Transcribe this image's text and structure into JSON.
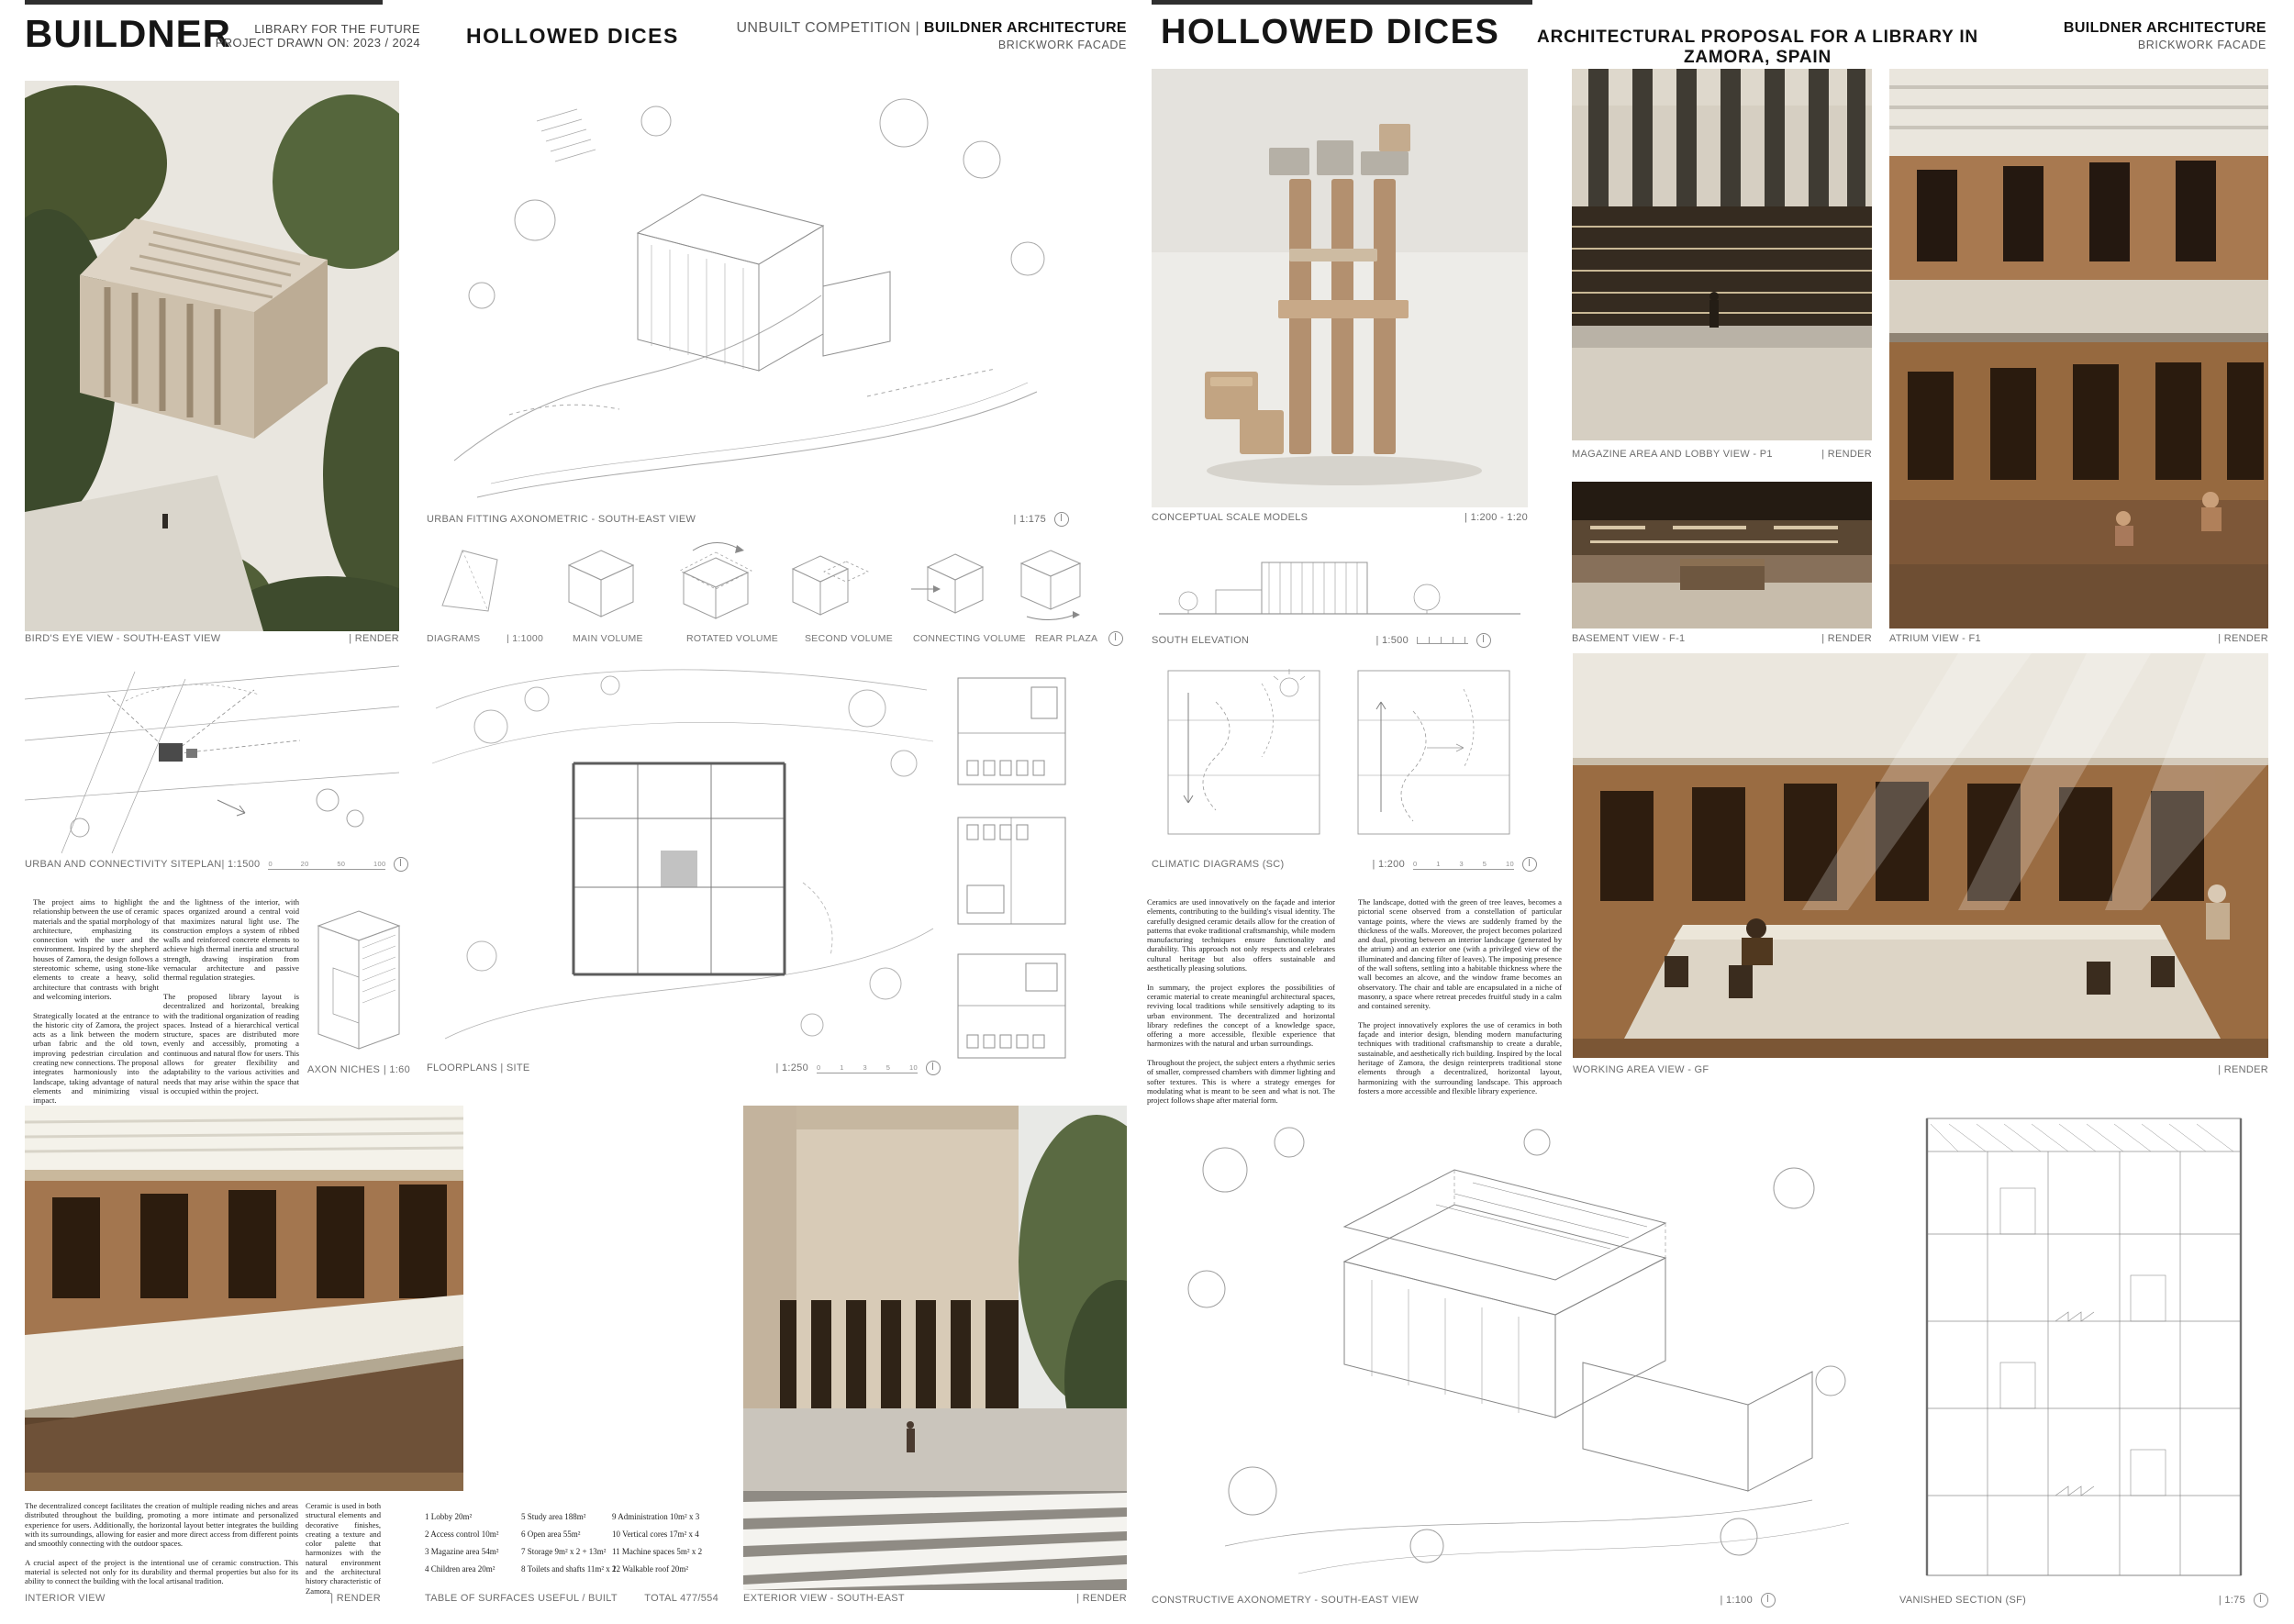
{
  "board_left": {
    "header": {
      "logo": "BUILDNER",
      "competition_line1": "LIBRARY FOR THE FUTURE",
      "competition_line2": "PROJECT DRAWN ON: 2023 / 2024",
      "title": "HOLLOWED DICES",
      "meta_regular": "UNBUILT COMPETITION | ",
      "meta_bold": "BUILDNER ARCHITECTURE",
      "meta_sub": "BRICKWORK FACADE"
    }
  },
  "board_right": {
    "header": {
      "title": "HOLLOWED DICES",
      "subtitle": "ARCHITECTURAL PROPOSAL FOR A LIBRARY IN ZAMORA, SPAIN",
      "meta_bold": "BUILDNER ARCHITECTURE",
      "meta_sub": "BRICKWORK FACADE"
    }
  },
  "captions": {
    "birds_eye": {
      "label": "BIRD'S EYE VIEW - SOUTH-EAST VIEW",
      "tag": "| RENDER"
    },
    "urban_axo": {
      "label": "URBAN FITTING AXONOMETRIC - SOUTH-EAST VIEW",
      "tag": "| 1:175"
    },
    "diagrams": {
      "label": "DIAGRAMS",
      "tag": "| 1:1000"
    },
    "siteplan": {
      "label": "URBAN AND CONNECTIVITY SITEPLAN",
      "tag": "| 1:1500"
    },
    "axon_niches": {
      "label": "AXON NICHES",
      "tag": "| 1:60"
    },
    "floorplans": {
      "label": "FLOORPLANS | SITE",
      "tag": "| 1:250"
    },
    "conceptual": {
      "label": "CONCEPTUAL SCALE MODELS",
      "tag": "| 1:200 - 1:20"
    },
    "south_elevation": {
      "label": "SOUTH ELEVATION",
      "tag": "| 1:500"
    },
    "climatic": {
      "label": "CLIMATIC DIAGRAMS (SC)",
      "tag": "| 1:200"
    },
    "magazine": {
      "label": "MAGAZINE AREA AND LOBBY VIEW - P1",
      "tag": "| RENDER"
    },
    "basement": {
      "label": "BASEMENT VIEW - F-1",
      "tag": "| RENDER"
    },
    "atrium": {
      "label": "ATRIUM VIEW - F1",
      "tag": "| RENDER"
    },
    "working": {
      "label": "WORKING AREA VIEW - GF",
      "tag": "| RENDER"
    },
    "interior": {
      "label": "INTERIOR VIEW",
      "tag": "| RENDER"
    },
    "table_surfaces": {
      "label": "TABLE OF SURFACES USEFUL / BUILT",
      "tag": "TOTAL 477/554"
    },
    "exterior": {
      "label": "EXTERIOR VIEW - SOUTH-EAST",
      "tag": "| RENDER"
    },
    "constructive": {
      "label": "CONSTRUCTIVE AXONOMETRY - SOUTH-EAST VIEW",
      "tag": "| 1:100"
    },
    "vanished": {
      "label": "VANISHED SECTION (SF)",
      "tag": "| 1:75"
    }
  },
  "diagram_labels": [
    "MAIN VOLUME",
    "ROTATED VOLUME",
    "SECOND VOLUME",
    "CONNECTING VOLUME",
    "REAR PLAZA"
  ],
  "scale_bars": {
    "siteplan": [
      "0",
      "20",
      "50",
      "100"
    ],
    "floorplans": [
      "0",
      "1",
      "3",
      "5",
      "10"
    ],
    "climatic": [
      "0",
      "1",
      "3",
      "5",
      "10"
    ]
  },
  "texts": {
    "left_col1": "The project aims to highlight the relationship between the use of ceramic materials and the spatial morphology of architecture, emphasizing its connection with the user and the environment. Inspired by the shepherd houses of Zamora, the design follows a stereotomic scheme, using stone-like elements to create a heavy, solid architecture that contrasts with bright and welcoming interiors.\n\nStrategically located at the entrance to the historic city of Zamora, the project acts as a link between the modern urban fabric and the old town, improving pedestrian circulation and creating new connections. The proposal integrates harmoniously into the landscape, taking advantage of natural elements and minimizing visual impact.\n\nThe interior design is characterized by a duality between the robust exterior",
    "left_col2": "and the lightness of the interior, with spaces organized around a central void that maximizes natural light use. The construction employs a system of ribbed walls and reinforced concrete elements to achieve high thermal inertia and structural strength, drawing inspiration from vernacular architecture and passive thermal regulation strategies.\n\nThe proposed library layout is decentralized and horizontal, breaking with the traditional organization of reading spaces. Instead of a hierarchical vertical structure, spaces are distributed more evenly and accessibly, promoting a continuous and natural flow for users. This allows for greater flexibility and adaptability to the various activities and needs that may arise within the space that is occupied within the project.",
    "right_col1": "Ceramics are used innovatively on the façade and interior elements, contributing to the building's visual identity. The carefully designed ceramic details allow for the creation of patterns that evoke traditional craftsmanship, while modern manufacturing techniques ensure functionality and durability. This approach not only respects and celebrates cultural heritage but also offers sustainable and aesthetically pleasing solutions.\n\nIn summary, the project explores the possibilities of ceramic material to create meaningful architectural spaces, reviving local traditions while sensitively adapting to its urban environment. The decentralized and horizontal library redefines the concept of a knowledge space, offering a more accessible, flexible experience that harmonizes with the natural and urban surroundings.\n\nThroughout the project, the subject enters a rhythmic series of smaller, compressed chambers with dimmer lighting and softer textures. This is where a strategy emerges for modulating what is meant to be seen and what is not. The project follows shape after material form.",
    "right_col2": "The landscape, dotted with the green of tree leaves, becomes a pictorial scene observed from a constellation of particular vantage points, where the views are suddenly framed by the thickness of the walls. Moreover, the project becomes polarized and dual, pivoting between an interior landscape (generated by the atrium) and an exterior one (with a privileged view of the illuminated and dancing filter of leaves). The imposing presence of the wall softens, settling into a habitable thickness where the wall becomes an alcove, and the window frame becomes an observatory. The chair and table are encapsulated in a niche of masonry, a space where retreat precedes fruitful study in a calm and contained serenity.\n\nThe project innovatively explores the use of ceramics in both façade and interior design, blending modern manufacturing techniques with traditional craftsmanship to create a durable, sustainable, and aesthetically rich building. Inspired by the local heritage of Zamora, the design reinterprets traditional stone elements through a decentralized, horizontal layout, harmonizing with the surrounding landscape. This approach fosters a more accessible and flexible library experience.",
    "bottom_main": "The decentralized concept facilitates the creation of multiple reading niches and areas distributed throughout the building, promoting a more intimate and personalized experience for users. Additionally, the horizontal layout better integrates the building with its surroundings, allowing for easier and more direct access from different points and smoothly connecting with the outdoor spaces.\n\nA crucial aspect of the project is the intentional use of ceramic construction. This material is selected not only for its durability and thermal properties but also for its ability to connect the building with the local artisanal tradition.",
    "bottom_side": "Ceramic is used in both structural elements and decorative finishes, creating a texture and color palette that harmonizes with the natural environment and the architectural history characteristic of Zamora."
  },
  "surface_table": {
    "a": [
      "1 Lobby 20m²",
      "2 Access control 10m²",
      "3 Magazine area 54m²",
      "4 Children area 20m²"
    ],
    "b": [
      "5 Study area 188m²",
      "6 Open area 55m²",
      "7 Storage 9m² x 2 + 13m²",
      "8 Toilets and shafts 11m² x 2"
    ],
    "c": [
      "9 Administration 10m² x 3",
      "10 Vertical cores 17m² x 4",
      "11 Machine spaces 5m² x 2",
      "12 Walkable roof 20m²"
    ]
  },
  "colors": {
    "brick": "#9c6f4e",
    "brick_dark": "#2a1c10",
    "concrete": "#d9d1c3",
    "green": "#4c5a36",
    "line": "#9a9a9a",
    "ink": "#151515"
  }
}
